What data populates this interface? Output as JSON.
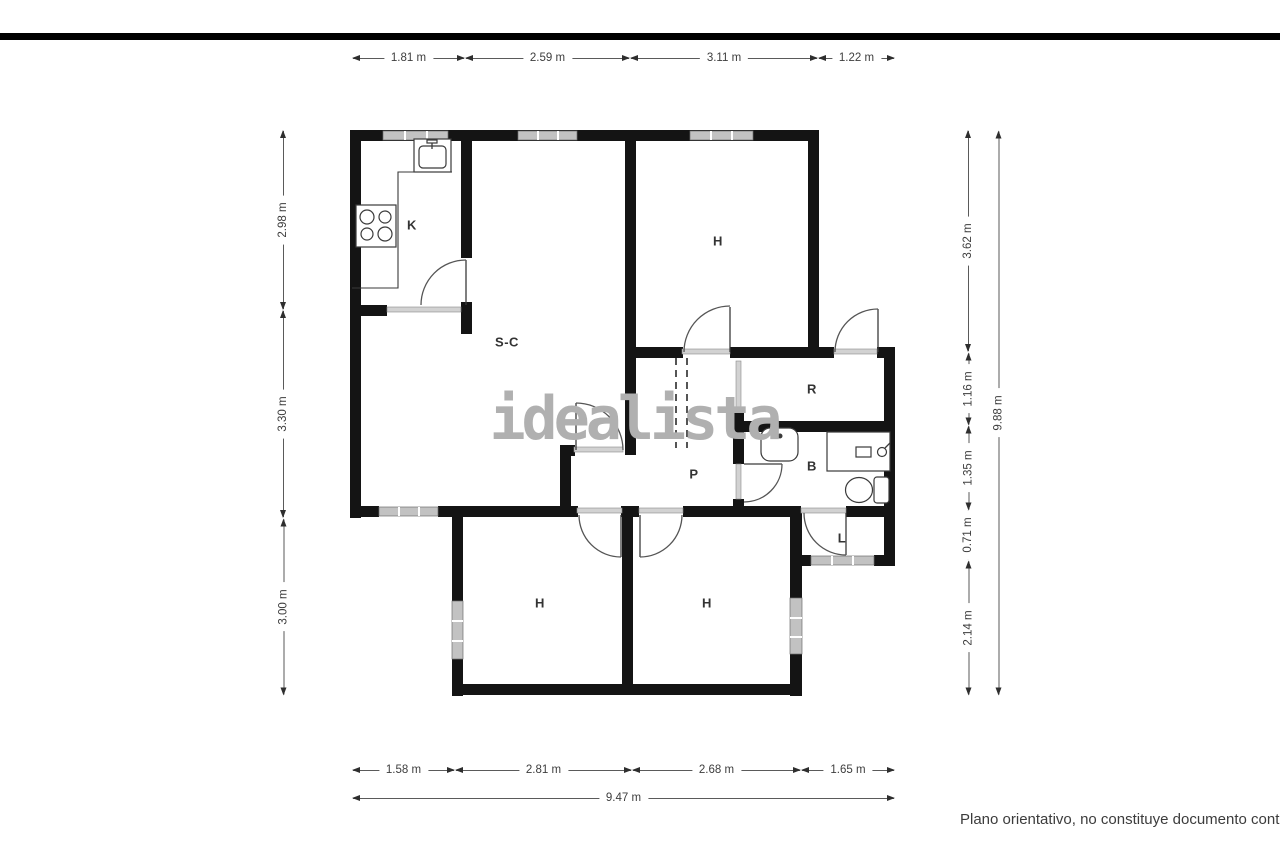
{
  "watermark": "idealista",
  "disclaimer": "Plano orientativo, no constituye documento contractua",
  "rooms": {
    "kitchen": "K",
    "bedroom-top": "H",
    "living-dining": "S-C",
    "hall": "R",
    "corridor": "P",
    "bathroom": "B",
    "laundry": "L",
    "bedroom-bottom-left": "H",
    "bedroom-bottom-right": "H"
  },
  "dimensions": {
    "top-0": "1.81 m",
    "top-1": "2.59 m",
    "top-2": "3.11 m",
    "top-3": "1.22 m",
    "bottom-0": "1.58 m",
    "bottom-1": "2.81 m",
    "bottom-2": "2.68 m",
    "bottom-3": "1.65 m",
    "bottom-total": "9.47 m",
    "left-0": "2.98 m",
    "left-1": "3.30 m",
    "left-2": "3.00 m",
    "right-0": "3.62 m",
    "right-1": "1.16 m",
    "right-2": "1.35 m",
    "right-3": "0.71 m",
    "right-4": "2.14 m",
    "right-total": "9.88 m"
  }
}
